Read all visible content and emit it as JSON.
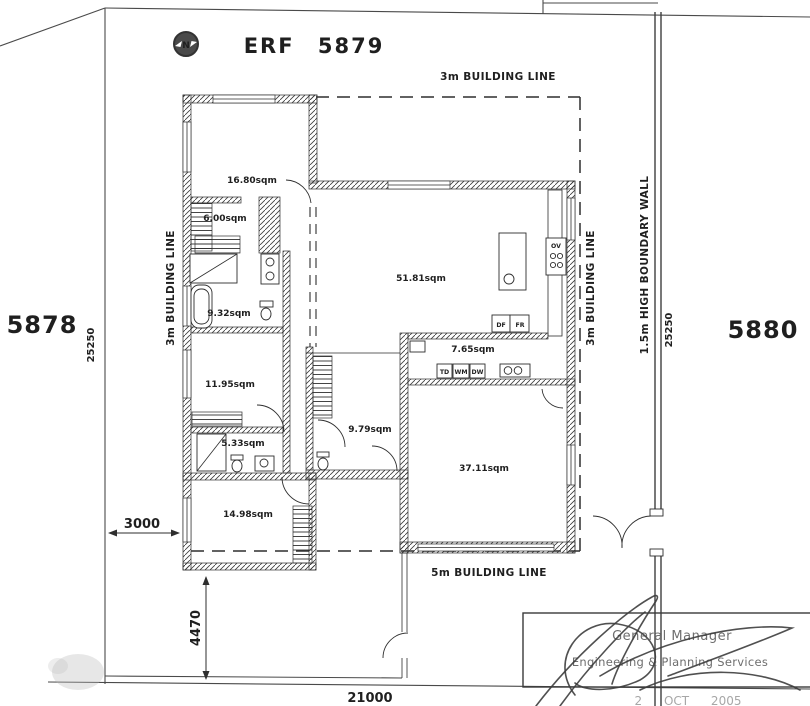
{
  "plan": {
    "title": "ERF 5879",
    "north_label": "N"
  },
  "neighbors": {
    "left": "5878",
    "right": "5880"
  },
  "building_lines": {
    "top": "3m BUILDING LINE",
    "left": "3m BUILDING LINE",
    "right": "3m BUILDING LINE",
    "front": "5m BUILDING LINE"
  },
  "boundary": {
    "wall_label": "1.5m HIGH BOUNDARY WALL",
    "left_length": "25250",
    "right_length": "25250",
    "front_length": "21000"
  },
  "dimensions": {
    "side_setback": "3000",
    "driveway": "4470"
  },
  "room_areas": [
    "16.80sqm",
    "6.00sqm",
    "9.32sqm",
    "11.95sqm",
    "5.33sqm",
    "14.98sqm",
    "51.81sqm",
    "7.65sqm",
    "9.79sqm",
    "37.11sqm"
  ],
  "appliances": {
    "td": "TD",
    "wm": "WM",
    "dw": "DW",
    "ov": "OV",
    "df": "DF",
    "fr": "FR"
  },
  "stamp": {
    "line1": "General Manager",
    "line2": "Engineering & Planning Services",
    "date": "2   OCT   2005"
  }
}
